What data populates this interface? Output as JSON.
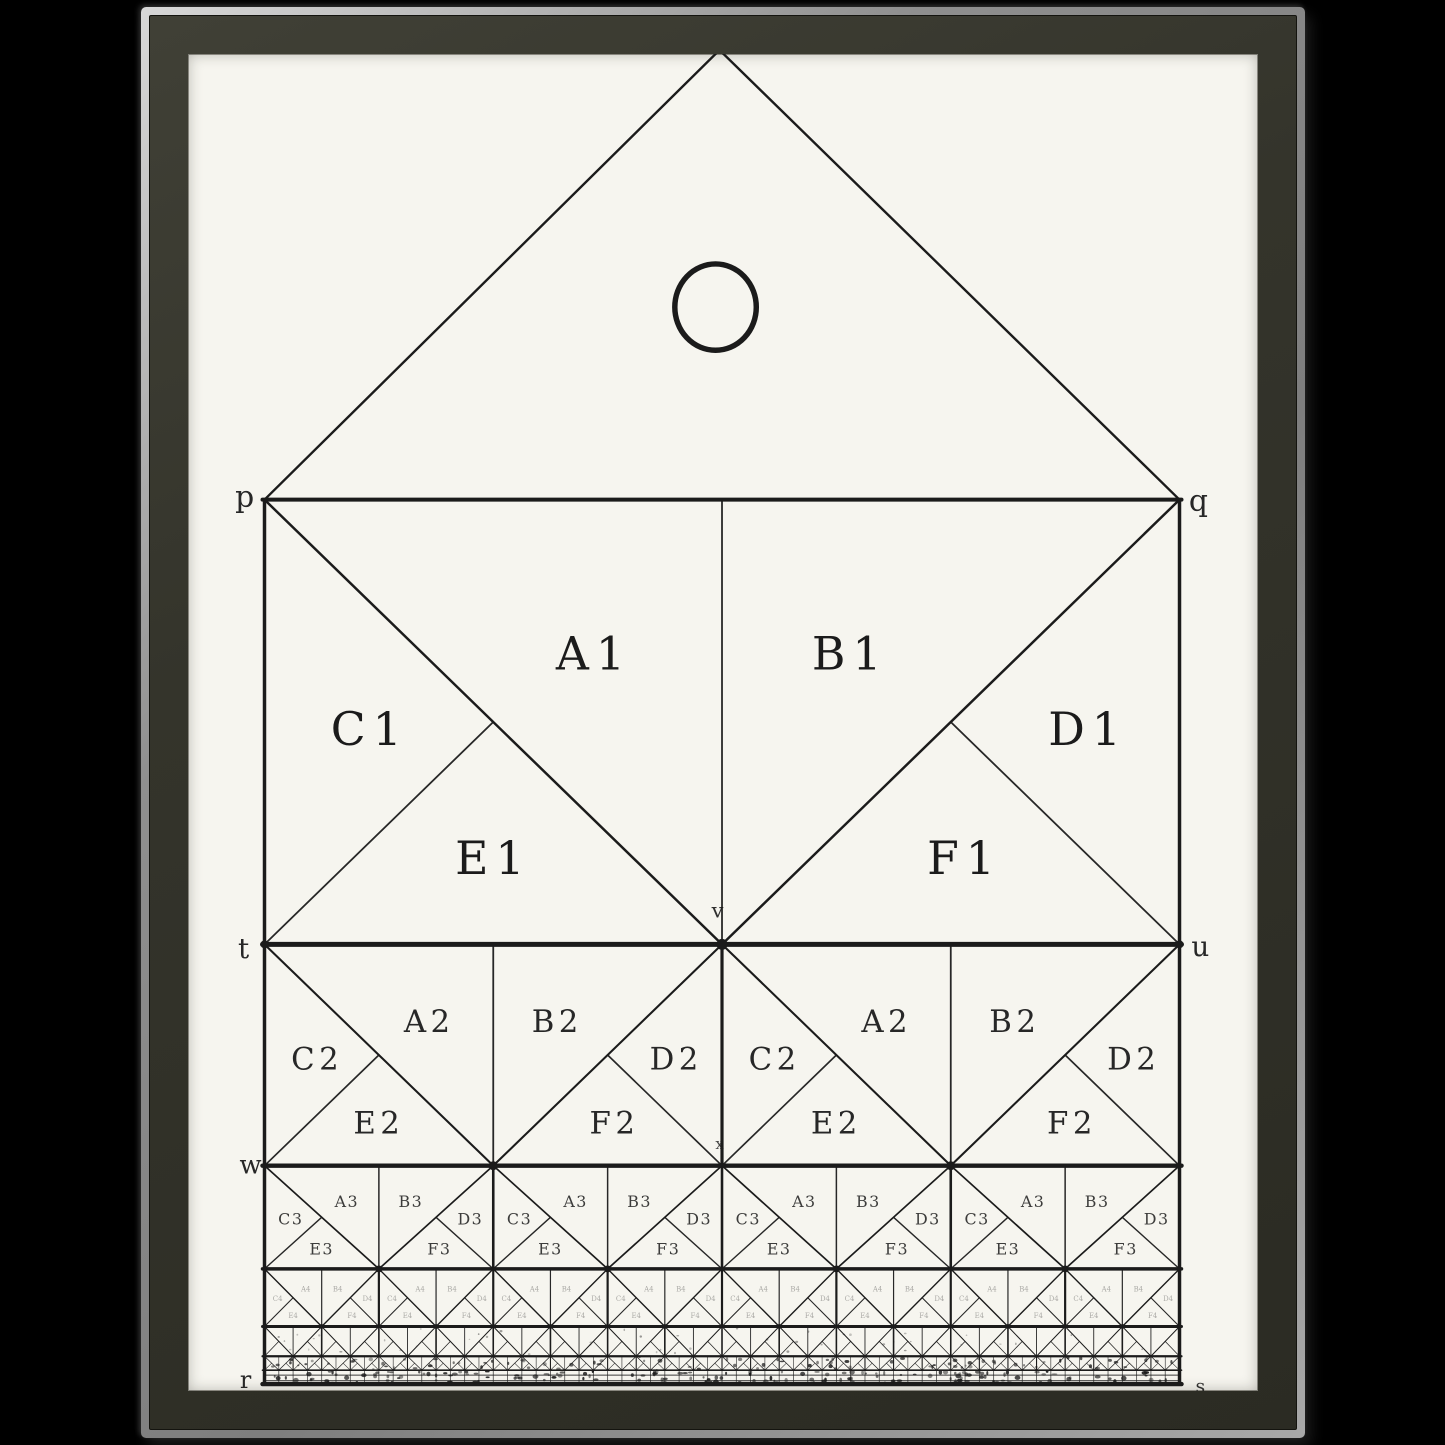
{
  "scene": {
    "background_color": "#000000",
    "frame_face_color": "#33332b",
    "frame_rim_light": "#d8d8d8",
    "frame_rim_dark": "#7e7e7e",
    "paper_color": "#f6f5ef",
    "ink_color": "#1b1b1b"
  },
  "diagram": {
    "kind": "recursive-rectangle-subdivision-figure",
    "gable_circle": {
      "present": true
    },
    "point_labels": [
      {
        "id": "p",
        "text": "p",
        "x": 57,
        "y": 446,
        "size": 30,
        "opacity": 0.95
      },
      {
        "id": "q",
        "text": "q",
        "x": 1017,
        "y": 450,
        "size": 30,
        "opacity": 0.95
      },
      {
        "id": "t",
        "text": "t",
        "x": 56,
        "y": 901,
        "size": 28,
        "opacity": 0.95
      },
      {
        "id": "u",
        "text": "u",
        "x": 1019,
        "y": 899,
        "size": 28,
        "opacity": 0.95
      },
      {
        "id": "v",
        "text": "v",
        "x": 533,
        "y": 863,
        "size": 21,
        "opacity": 0.9
      },
      {
        "id": "w",
        "text": "w",
        "x": 63,
        "y": 1119,
        "size": 26,
        "opacity": 0.95
      },
      {
        "id": "x",
        "text": "x",
        "x": 535,
        "y": 1098,
        "size": 15,
        "opacity": 0.8
      },
      {
        "id": "r",
        "text": "r",
        "x": 58,
        "y": 1336,
        "size": 24,
        "opacity": 0.95
      },
      {
        "id": "s",
        "text": "s",
        "x": 1019,
        "y": 1342,
        "size": 19,
        "opacity": 0.9
      }
    ],
    "rows": [
      {
        "row": 1,
        "cells": 1,
        "labels": [
          "A1",
          "B1",
          "C1",
          "D1",
          "E1",
          "F1"
        ]
      },
      {
        "row": 2,
        "cells": 2,
        "labels": [
          "A2",
          "B2",
          "C2",
          "D2",
          "E2",
          "F2"
        ]
      },
      {
        "row": 3,
        "cells": 4,
        "labels": [
          "A3",
          "B3",
          "C3",
          "D3",
          "E3",
          "F3"
        ]
      },
      {
        "row": 4,
        "cells": 8,
        "labels": [
          "A4",
          "B4",
          "C4",
          "D4",
          "E4",
          "F4"
        ]
      },
      {
        "row": 5,
        "cells": 16,
        "labels": []
      },
      {
        "row": 6,
        "cells": 32,
        "labels": []
      }
    ]
  }
}
